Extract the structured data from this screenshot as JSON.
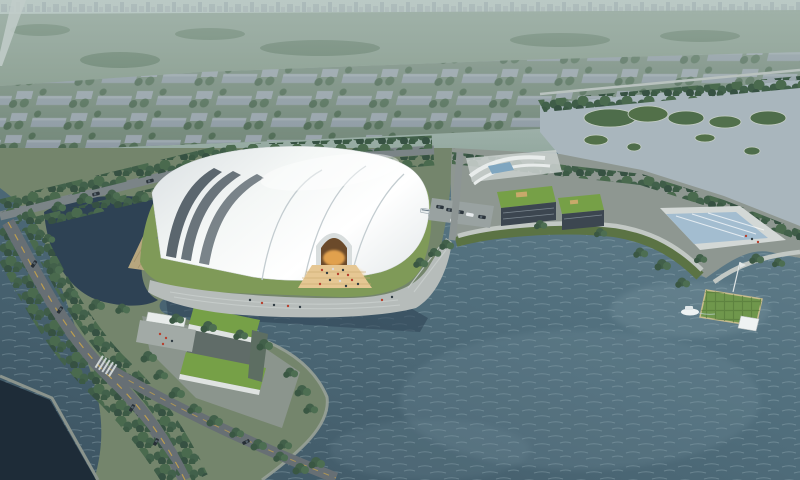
{
  "meta": {
    "type": "aerial-architectural-rendering",
    "title": "Aerial rendering of a lakeside white shell-roofed stadium complex with waterfront plaza, green-roof annex buildings, tree-lined boulevard, wetland islands, pier and boat",
    "width_px": 800,
    "height_px": 480
  },
  "palette": {
    "haze_top": "#b8c7c3",
    "haze_bottom": "#93a89f",
    "mist": "#bccbc7",
    "distant_field": "#7e9484",
    "distant_block_base": "#6d8272",
    "wetland_water": "#a9b6bd",
    "bay_top": "#6d8894",
    "bay_mid": "#52707e",
    "bay_deep": "#3e5664",
    "pond_water": "#2e4254",
    "canal_water": "#1e2c38",
    "land_green": "#74856c",
    "lawn": "#7f9a58",
    "plaza": "#b6bcba",
    "plaza_mid": "#8e9791",
    "road": "#676f74",
    "road_light": "#7b8487",
    "road_marking": "#c9a44a",
    "roof_white": "#f2f5f4",
    "shell_gap": "#5b666e",
    "facade_dark": "#46525d",
    "entrance_glow": "#e8a64f",
    "entrance_apron": "#e6c793",
    "entrance_opening": "#6b4a2a",
    "beach_sand": "#b7a67e",
    "green_roof": "#76a047",
    "annex_facade": "#3c4650",
    "pool_water": "#a3bdd0",
    "deck_white": "#d3d8d6",
    "pier_lawn": "#6f974c",
    "boat_white": "#eef2f3",
    "embankment": "#98a198",
    "promenade": "#c2c8c4",
    "slope_green": "#5b7344",
    "people_red": "#b6402e",
    "people_dark": "#2f3b42"
  },
  "scene": {
    "regions": [
      {
        "id": "distant-city",
        "label": "hazy distant city blocks, fields and skyline"
      },
      {
        "id": "wetland",
        "label": "pale wetland water with tree-covered islands"
      },
      {
        "id": "boulevard",
        "label": "tree-lined boulevard with cars and crosswalk"
      },
      {
        "id": "pond",
        "label": "dark landscaped pond west of the hall"
      },
      {
        "id": "main-hall",
        "label": "white ribbed shell exhibition / sports hall"
      },
      {
        "id": "entrance",
        "label": "glowing amber entrance arch with visitors"
      },
      {
        "id": "waterfront-plaza",
        "label": "stepped waterfront plaza"
      },
      {
        "id": "bay",
        "label": "large rippled bay"
      },
      {
        "id": "annex",
        "label": "green-roof annex buildings with reflecting pool"
      },
      {
        "id": "pier",
        "label": "green pier with white pavilion and moored boat"
      },
      {
        "id": "gatehouse",
        "label": "U-shaped green-roof gatehouse with white canopy"
      },
      {
        "id": "canal",
        "label": "dark canal at the south-west corner"
      }
    ],
    "counts": {
      "buses": 3,
      "cars": 13,
      "boats": 1,
      "wetland_islands": 9
    }
  }
}
